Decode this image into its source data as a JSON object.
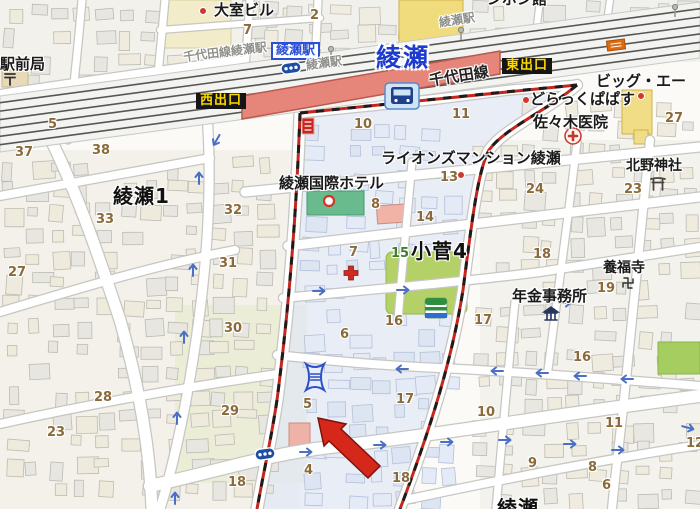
{
  "map": {
    "colors": {
      "boundary_red": "#c2281e",
      "station_fill": "#e6857a",
      "highlight_zone": "#dfe7f5",
      "park_green": "#b4d168",
      "exit_bg": "#151515",
      "exit_text": "#ffd900",
      "station_name_blue": "#1d3ccf",
      "red_arrow": "#d5281b"
    },
    "station": {
      "name_big": "綾瀬",
      "line": "千代田線",
      "station_box": "綾瀬駅",
      "west_exit": "西出口",
      "east_exit": "東出口"
    },
    "districts": [
      {
        "text": "綾瀬1",
        "x": 113,
        "y": 186
      },
      {
        "text": "小菅4",
        "x": 411,
        "y": 241
      },
      {
        "text": "綾瀬",
        "x": 497,
        "y": 498
      }
    ],
    "poi_labels": [
      {
        "text": "大室ビル",
        "x": 214,
        "y": 3,
        "cls": "poi"
      },
      {
        "text": "駅前局",
        "x": 0,
        "y": 57,
        "cls": "poi"
      },
      {
        "text": "ンポン館",
        "x": 487,
        "y": -8,
        "cls": "poi"
      },
      {
        "text": "ライオンズマンション綾瀬",
        "x": 381,
        "y": 151,
        "cls": "poi"
      },
      {
        "text": "綾瀬国際ホテル",
        "x": 279,
        "y": 176,
        "cls": "poi"
      },
      {
        "text": "どらっくぱぱす",
        "x": 530,
        "y": 92,
        "cls": "poi"
      },
      {
        "text": "ビッグ・エー",
        "x": 596,
        "y": 74,
        "cls": "poi"
      },
      {
        "text": "佐々木医院",
        "x": 533,
        "y": 115,
        "cls": "poi"
      },
      {
        "text": "北野神社",
        "x": 626,
        "y": 159,
        "cls": "poi-sm"
      },
      {
        "text": "養福寺",
        "x": 603,
        "y": 261,
        "cls": "poi-sm"
      },
      {
        "text": "年金事務所",
        "x": 512,
        "y": 289,
        "cls": "poi"
      },
      {
        "text": "千代田線綾瀬駅",
        "x": 183,
        "y": 46,
        "cls": "grey",
        "rot": -7
      },
      {
        "text": "綾瀬駅",
        "x": 306,
        "y": 57,
        "cls": "grey",
        "rot": -8
      },
      {
        "text": "綾瀬駅",
        "x": 439,
        "y": 14,
        "cls": "grey",
        "rot": -9
      }
    ],
    "block_numbers": [
      {
        "n": "5",
        "x": 48,
        "y": 118
      },
      {
        "n": "37",
        "x": 15,
        "y": 146
      },
      {
        "n": "38",
        "x": 92,
        "y": 144
      },
      {
        "n": "7",
        "x": 243,
        "y": 24
      },
      {
        "n": "2",
        "x": 310,
        "y": 9
      },
      {
        "n": "33",
        "x": 96,
        "y": 213
      },
      {
        "n": "27",
        "x": 8,
        "y": 266
      },
      {
        "n": "32",
        "x": 224,
        "y": 204
      },
      {
        "n": "31",
        "x": 219,
        "y": 257
      },
      {
        "n": "30",
        "x": 224,
        "y": 322
      },
      {
        "n": "28",
        "x": 94,
        "y": 391
      },
      {
        "n": "23",
        "x": 47,
        "y": 426
      },
      {
        "n": "29",
        "x": 221,
        "y": 405
      },
      {
        "n": "18",
        "x": 228,
        "y": 476
      },
      {
        "n": "10",
        "x": 354,
        "y": 118
      },
      {
        "n": "11",
        "x": 452,
        "y": 108
      },
      {
        "n": "27",
        "x": 665,
        "y": 112
      },
      {
        "n": "13",
        "x": 440,
        "y": 171
      },
      {
        "n": "14",
        "x": 416,
        "y": 211
      },
      {
        "n": "8",
        "x": 371,
        "y": 198
      },
      {
        "n": "7",
        "x": 349,
        "y": 246
      },
      {
        "n": "24",
        "x": 526,
        "y": 183
      },
      {
        "n": "23",
        "x": 624,
        "y": 183
      },
      {
        "n": "18",
        "x": 533,
        "y": 248
      },
      {
        "n": "19",
        "x": 597,
        "y": 282
      },
      {
        "n": "15",
        "x": 391,
        "y": 247,
        "green": true
      },
      {
        "n": "16",
        "x": 385,
        "y": 315
      },
      {
        "n": "17",
        "x": 474,
        "y": 314
      },
      {
        "n": "16",
        "x": 573,
        "y": 351
      },
      {
        "n": "6",
        "x": 340,
        "y": 328
      },
      {
        "n": "5",
        "x": 303,
        "y": 398
      },
      {
        "n": "4",
        "x": 304,
        "y": 464
      },
      {
        "n": "17",
        "x": 396,
        "y": 393
      },
      {
        "n": "10",
        "x": 477,
        "y": 406
      },
      {
        "n": "11",
        "x": 605,
        "y": 417
      },
      {
        "n": "18",
        "x": 392,
        "y": 472
      },
      {
        "n": "9",
        "x": 528,
        "y": 457
      },
      {
        "n": "8",
        "x": 588,
        "y": 461
      },
      {
        "n": "6",
        "x": 602,
        "y": 479
      },
      {
        "n": "12",
        "x": 686,
        "y": 437
      }
    ],
    "icons": [
      {
        "name": "red-dot-icon",
        "t": "dot",
        "x": 203,
        "y": 11
      },
      {
        "name": "red-dot-icon",
        "t": "dot",
        "x": 461,
        "y": 175
      },
      {
        "name": "red-dot-icon",
        "t": "dot",
        "x": 526,
        "y": 100
      },
      {
        "name": "red-dot-icon",
        "t": "dot",
        "x": 641,
        "y": 96
      },
      {
        "name": "hotel-ring-icon",
        "t": "ring",
        "x": 329,
        "y": 201
      },
      {
        "name": "hospital-icon",
        "t": "hosp",
        "x": 573,
        "y": 136
      },
      {
        "name": "clinic-cross-icon",
        "t": "cross",
        "x": 351,
        "y": 273
      },
      {
        "name": "post-office-icon",
        "t": "post",
        "x": 10,
        "y": 79
      },
      {
        "name": "torii-shrine-icon",
        "t": "torii",
        "x": 658,
        "y": 184
      },
      {
        "name": "temple-manji-icon",
        "t": "manji",
        "x": 628,
        "y": 283
      },
      {
        "name": "pension-office-building-icon",
        "t": "bank",
        "x": 551,
        "y": 314
      },
      {
        "name": "bus-stop-icon",
        "t": "bus",
        "x": 291,
        "y": 68,
        "r": -8
      },
      {
        "name": "bus-stop-icon",
        "t": "bus",
        "x": 265,
        "y": 454,
        "r": -8
      },
      {
        "name": "signpost-icon",
        "t": "pole",
        "x": 331,
        "y": 49
      },
      {
        "name": "signpost-icon",
        "t": "pole",
        "x": 461,
        "y": 30
      },
      {
        "name": "signpost-icon",
        "t": "pole",
        "x": 675,
        "y": 7
      },
      {
        "name": "subway-train-icon",
        "t": "train",
        "x": 402,
        "y": 96
      },
      {
        "name": "convenience-store-icon",
        "t": "store",
        "x": 436,
        "y": 308
      },
      {
        "name": "bathhouse-icon",
        "t": "bath",
        "x": 315,
        "y": 377
      },
      {
        "name": "red-sign-badge",
        "t": "rbadge",
        "x": 308,
        "y": 126
      },
      {
        "name": "orange-sign-badge",
        "t": "obadge",
        "x": 616,
        "y": 45,
        "r": -7
      }
    ],
    "one_way_arrows": [
      {
        "x": 216,
        "y": 141,
        "r": 120
      },
      {
        "x": 199,
        "y": 177,
        "r": -90
      },
      {
        "x": 193,
        "y": 269,
        "r": -90
      },
      {
        "x": 184,
        "y": 336,
        "r": -90
      },
      {
        "x": 177,
        "y": 417,
        "r": -90
      },
      {
        "x": 175,
        "y": 497,
        "r": -90
      },
      {
        "x": 320,
        "y": 291,
        "r": 0
      },
      {
        "x": 404,
        "y": 290,
        "r": 0
      },
      {
        "x": 566,
        "y": 303,
        "r": 0
      },
      {
        "x": 401,
        "y": 369,
        "r": 180
      },
      {
        "x": 496,
        "y": 371,
        "r": 180
      },
      {
        "x": 541,
        "y": 373,
        "r": 180
      },
      {
        "x": 579,
        "y": 376,
        "r": 180
      },
      {
        "x": 626,
        "y": 379,
        "r": 180
      },
      {
        "x": 307,
        "y": 452,
        "r": 0
      },
      {
        "x": 381,
        "y": 445,
        "r": 0
      },
      {
        "x": 448,
        "y": 442,
        "r": 0
      },
      {
        "x": 506,
        "y": 440,
        "r": 0
      },
      {
        "x": 571,
        "y": 444,
        "r": 0
      },
      {
        "x": 619,
        "y": 450,
        "r": 0
      },
      {
        "x": 689,
        "y": 428,
        "r": 15
      }
    ]
  }
}
